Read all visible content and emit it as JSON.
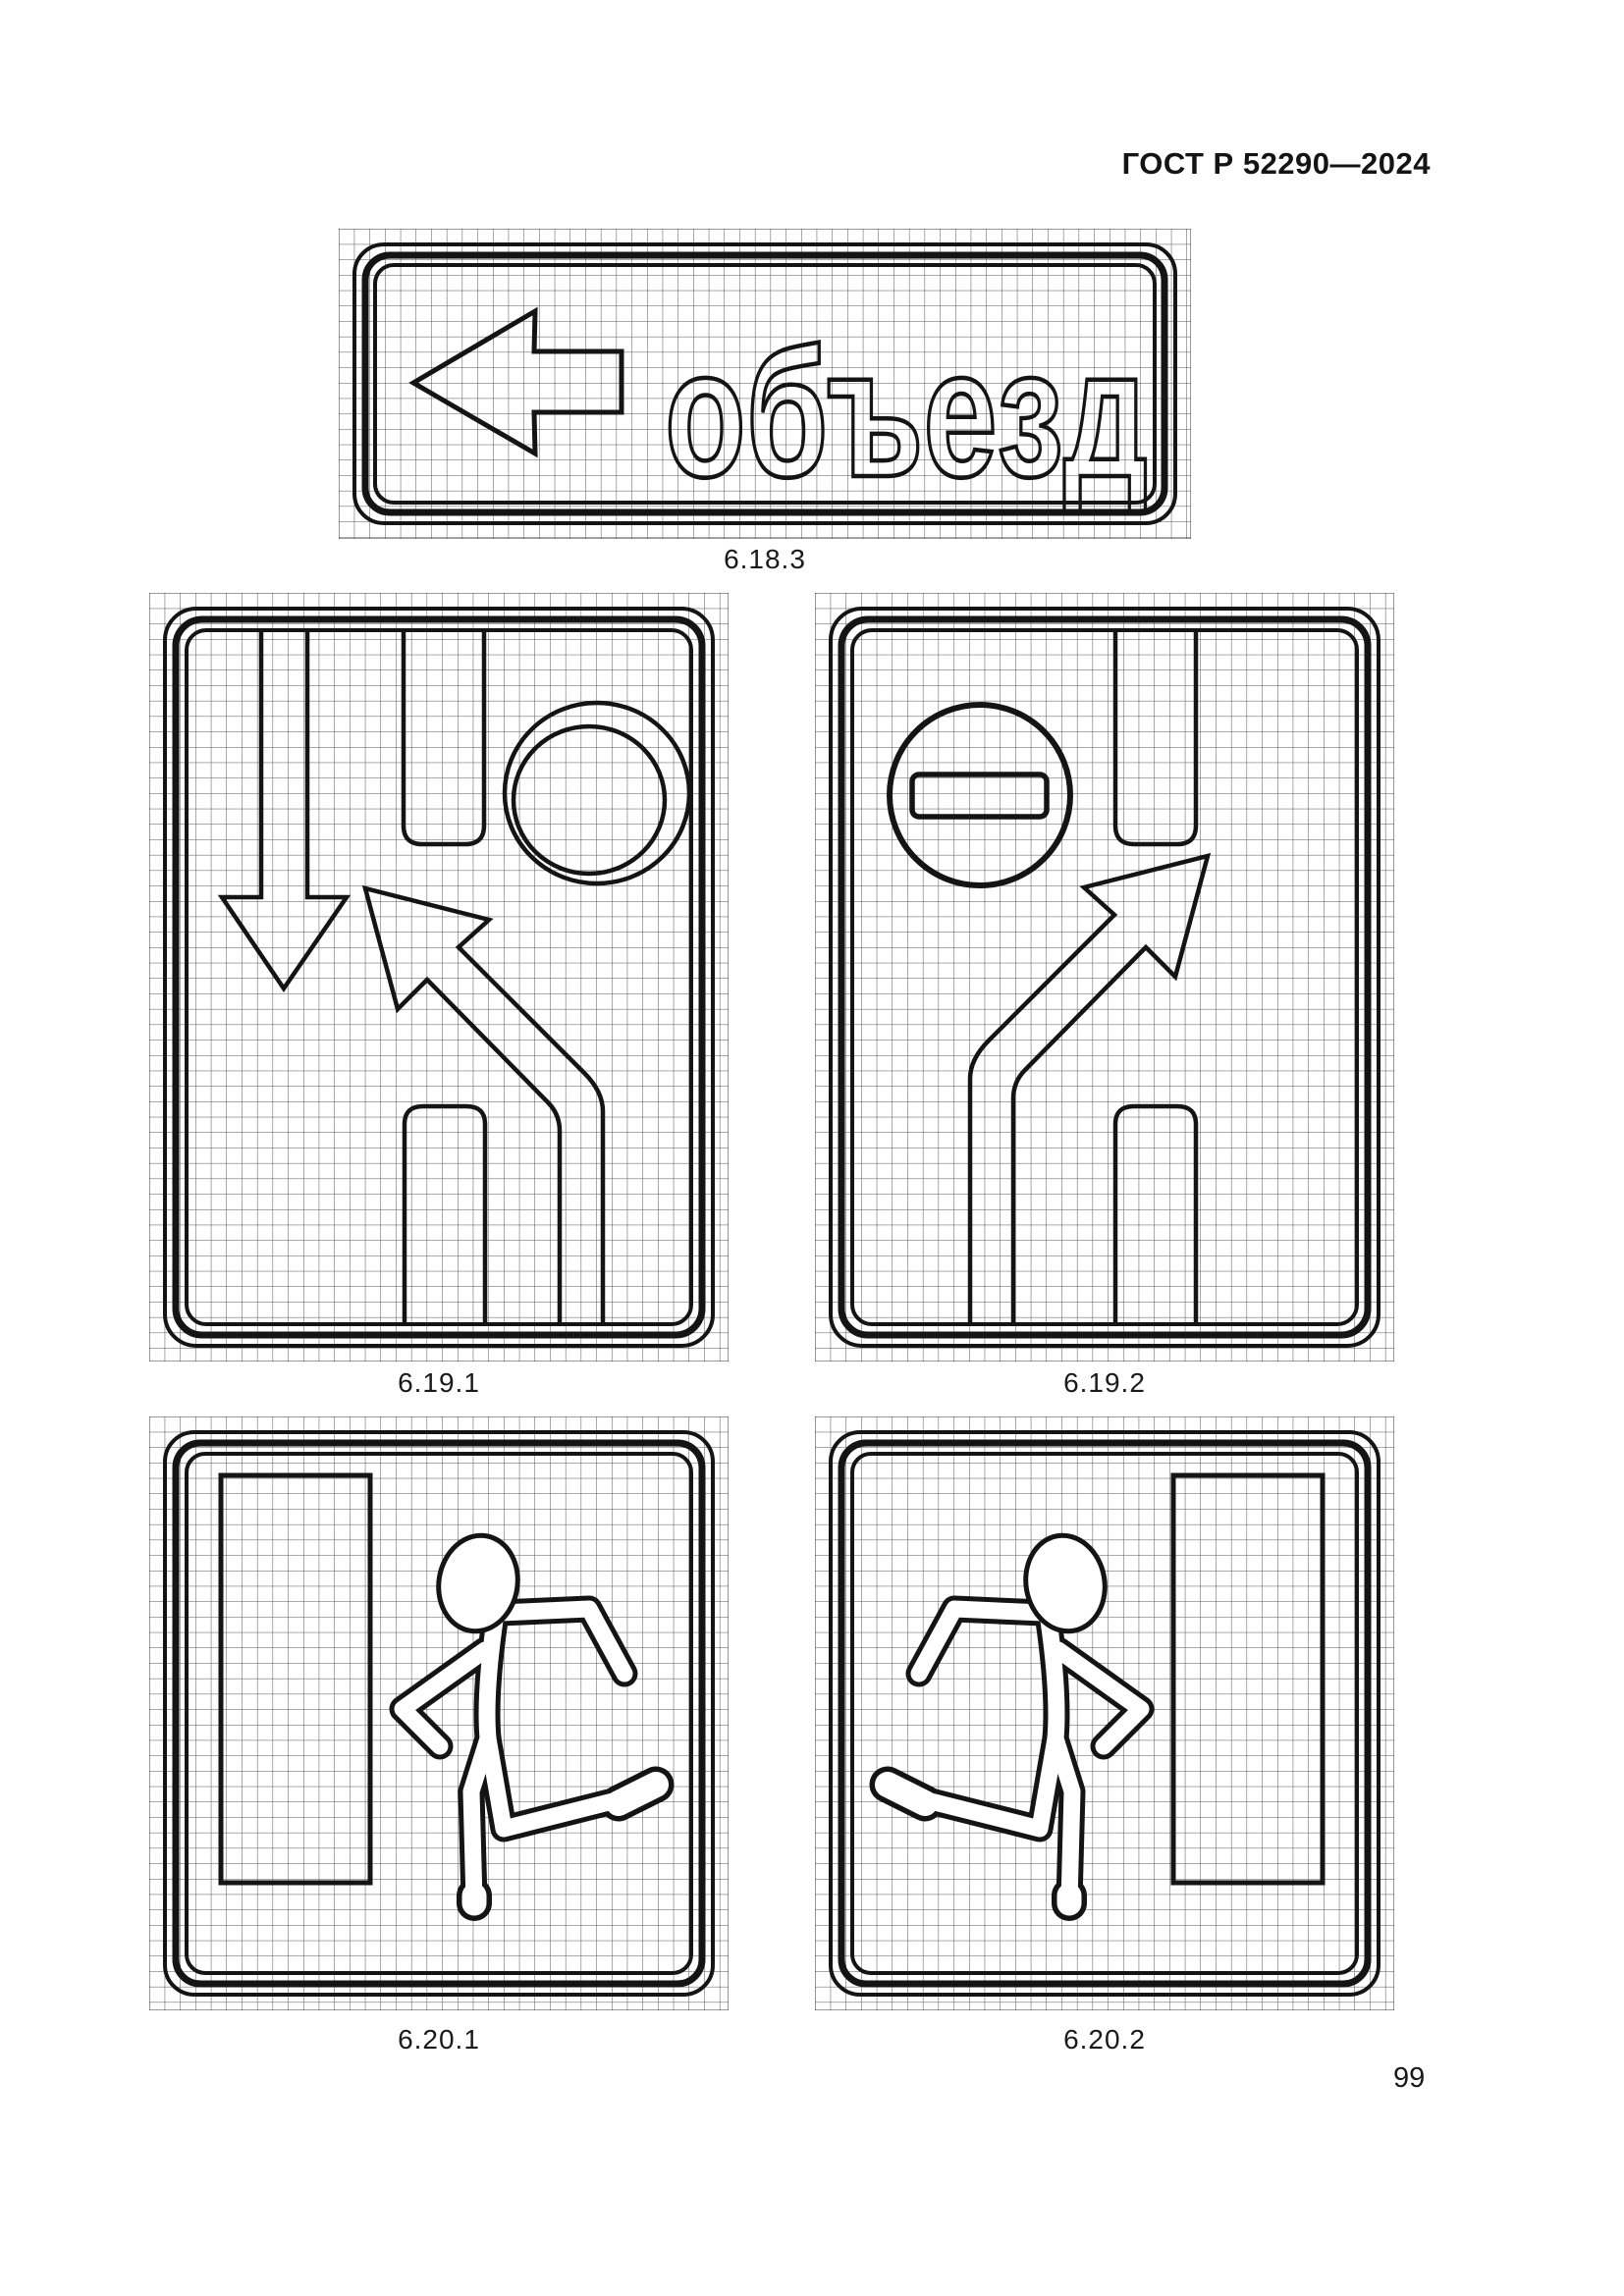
{
  "page": {
    "header": "ГОСТ Р 52290—2024",
    "page_number": "99"
  },
  "colors": {
    "ink": "#141414",
    "paper": "#ffffff",
    "grid_line": "#333333"
  },
  "signs": [
    {
      "id": "6.18.3",
      "label": "6.18.3",
      "text": "объезд",
      "icons": [
        "left-arrow-icon"
      ]
    },
    {
      "id": "6.19.1",
      "label": "6.19.1",
      "icons": [
        "down-arrow-icon",
        "double-ring-icon",
        "up-left-bent-arrow-icon",
        "road-lane-lines"
      ]
    },
    {
      "id": "6.19.2",
      "label": "6.19.2",
      "icons": [
        "no-entry-icon",
        "up-right-bent-arrow-icon",
        "road-lane-lines"
      ]
    },
    {
      "id": "6.20.1",
      "label": "6.20.1",
      "icons": [
        "door-icon",
        "running-person-icon"
      ]
    },
    {
      "id": "6.20.2",
      "label": "6.20.2",
      "icons": [
        "running-person-icon",
        "door-icon"
      ]
    }
  ]
}
